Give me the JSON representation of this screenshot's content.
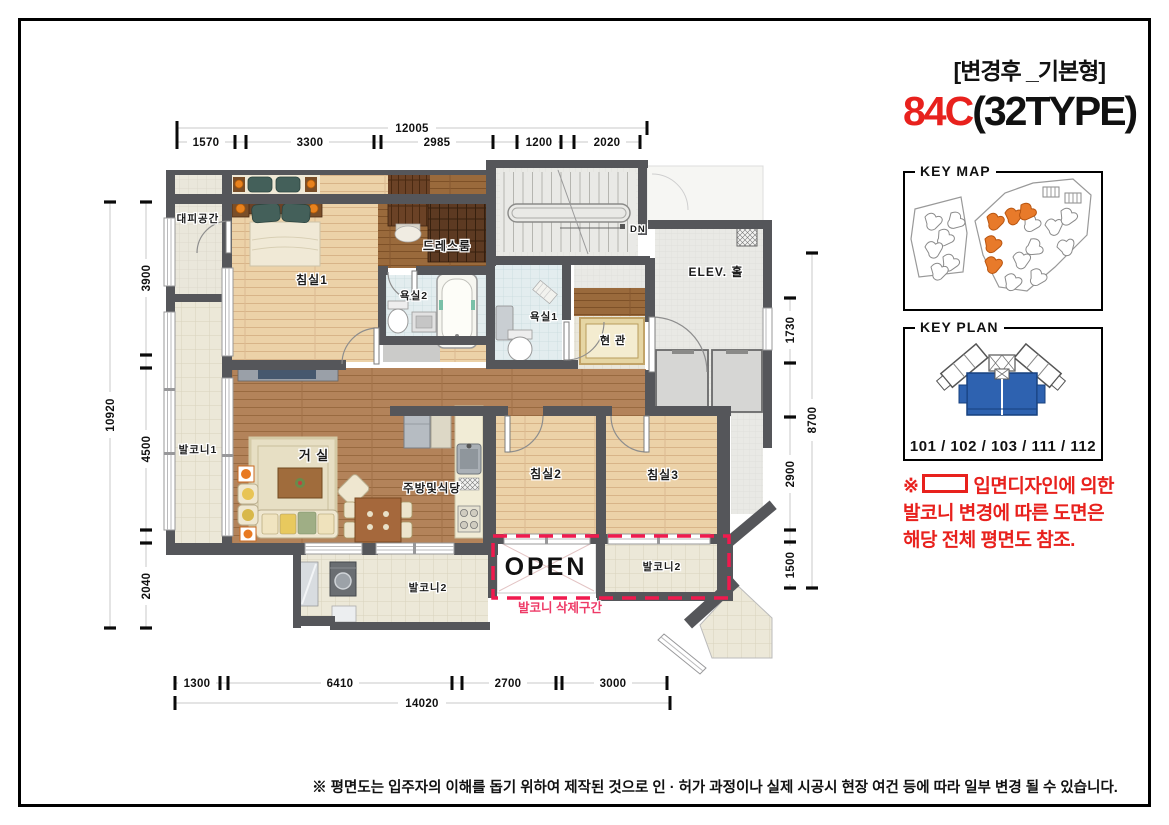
{
  "header": {
    "revision_tag": "[변경후 _기본형]",
    "unit_code": "84C",
    "unit_type": "(32TYPE)"
  },
  "key_map": {
    "title": "KEY MAP"
  },
  "key_plan": {
    "title": "KEY PLAN",
    "units": "101 / 102 / 103 / 111 / 112"
  },
  "note": {
    "prefix": "※",
    "line1_after_symbol": "입면디자인에 의한",
    "line2": "발코니 변경에 따른 도면은",
    "line3": "해당 전체 평면도 참조."
  },
  "rooms": {
    "escape_space": "대피공간",
    "bedroom1": "침실1",
    "dressroom": "드레스룸",
    "bathroom2": "욕실2",
    "bathroom1": "욕실1",
    "entrance": "현 관",
    "elevator_hall": "ELEV. 홀",
    "stair_down": "DN",
    "balcony1": "발코니1",
    "living_room": "거 실",
    "kitchen_dining": "주방및식당",
    "bedroom2": "침실2",
    "bedroom3": "침실3",
    "balcony2_left": "발코니2",
    "open_space": "OPEN",
    "balcony2_right": "발코니2",
    "balcony_removed_zone": "발코니 삭제구간"
  },
  "dimensions": {
    "top": {
      "total": "12005",
      "segments": [
        "1570",
        "3300",
        "2985",
        "1200",
        "2020"
      ]
    },
    "bottom": {
      "total": "14020",
      "segments": [
        "1300",
        "6410",
        "2700",
        "3000"
      ]
    },
    "left": {
      "total": "10920",
      "segments": [
        "3900",
        "4500",
        "2040"
      ]
    },
    "right": {
      "total": "8700",
      "segments": [
        "1730",
        "2900",
        "1500"
      ]
    }
  },
  "footer": {
    "disclaimer": "※ 평면도는 입주자의 이해를 돕기 위하여 제작된 것으로 인 · 허가 과정이나 실제 시공시 현장 여건 등에 따라 일부 변경 될 수 있습니다."
  },
  "colors": {
    "accent_red": "#e8211d",
    "dashed_zone": "#f01a4e",
    "keymap_highlight": "#e87a2a",
    "keyplan_highlight": "#2e62b0"
  }
}
